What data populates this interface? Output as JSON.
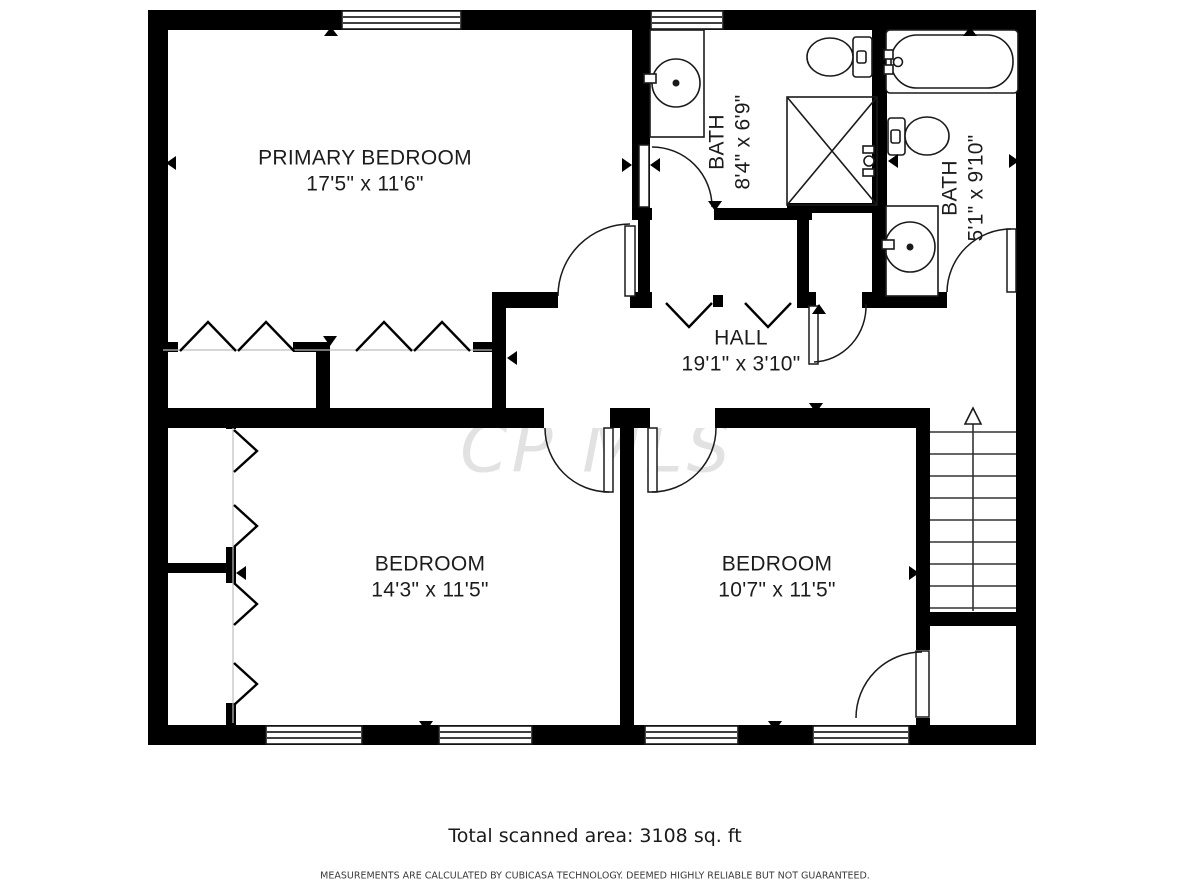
{
  "plan": {
    "watermark": "CP MLS",
    "rooms": [
      {
        "name": "PRIMARY BEDROOM",
        "dims": "17'5\" x 11'6\""
      },
      {
        "name": "BATH",
        "dims": "8'4\" x 6'9\""
      },
      {
        "name": "BATH",
        "dims": "5'1\" x 9'10\""
      },
      {
        "name": "HALL",
        "dims": "19'1\" x 3'10\""
      },
      {
        "name": "BEDROOM",
        "dims": "14'3\" x 11'5\""
      },
      {
        "name": "BEDROOM",
        "dims": "10'7\" x 11'5\""
      }
    ],
    "fixtures": [
      "bathtub-icon",
      "toilet-icon",
      "sink-icon",
      "shower-icon",
      "stairs-icon",
      "door-swing-icon",
      "window-icon",
      "bifold-door-icon",
      "up-arrow-icon"
    ]
  },
  "footer": {
    "total_area": "Total scanned area: 3108 sq. ft",
    "disclaimer": "MEASUREMENTS ARE CALCULATED BY CUBICASA TECHNOLOGY. DEEMED HIGHLY RELIABLE BUT NOT GUARANTEED."
  },
  "colors": {
    "wall": "#000000",
    "background": "#ffffff",
    "watermark": "#e2e2e2",
    "label": "#1c1c1c"
  }
}
